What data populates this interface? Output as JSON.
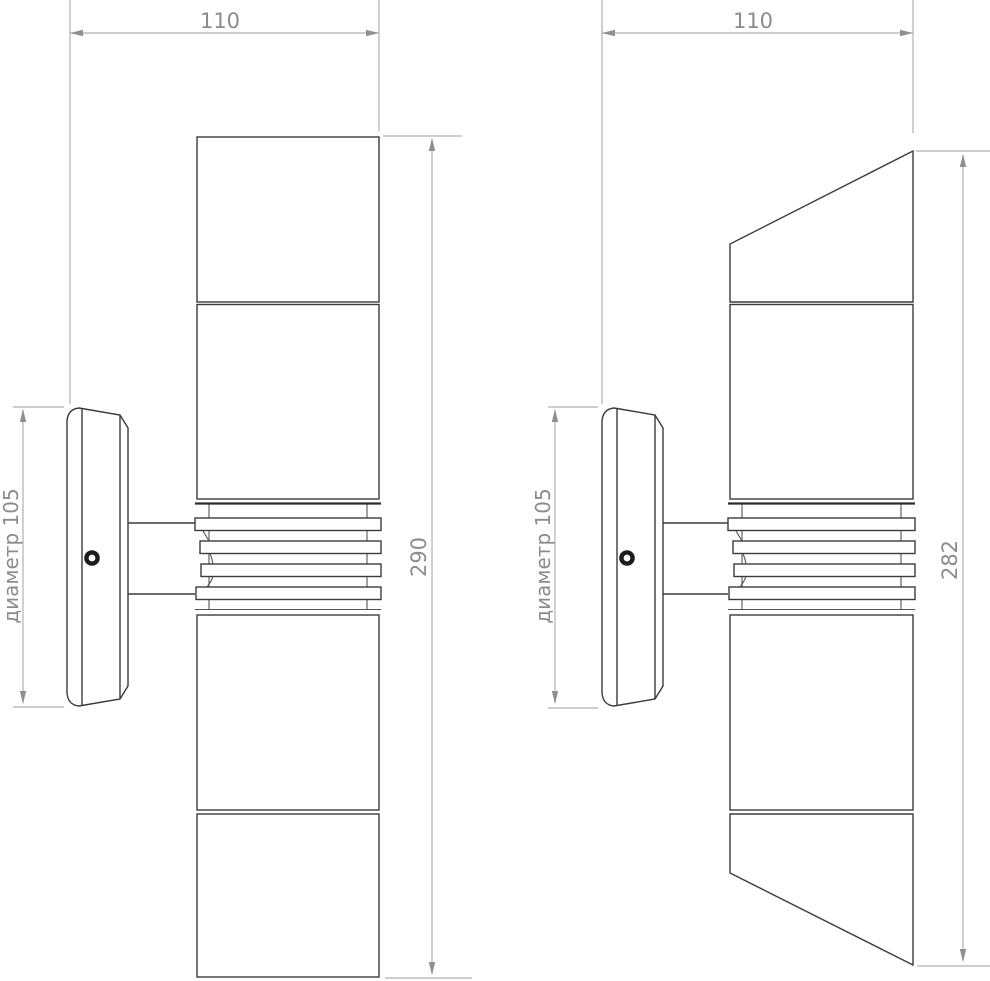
{
  "drawing": {
    "views": [
      {
        "width_dim": "110",
        "height_dim": "290",
        "diameter_dim": "диаметр 105"
      },
      {
        "width_dim": "110",
        "height_dim": "282",
        "diameter_dim": "диаметр 105"
      }
    ],
    "colors": {
      "object_line": "#3b3b3b",
      "heavy_line": "#2c2c2c",
      "dimension_line": "#b0b0b0",
      "dimension_text": "#8c8c8c",
      "screw": "#1c1c1c",
      "background": "#ffffff"
    }
  }
}
